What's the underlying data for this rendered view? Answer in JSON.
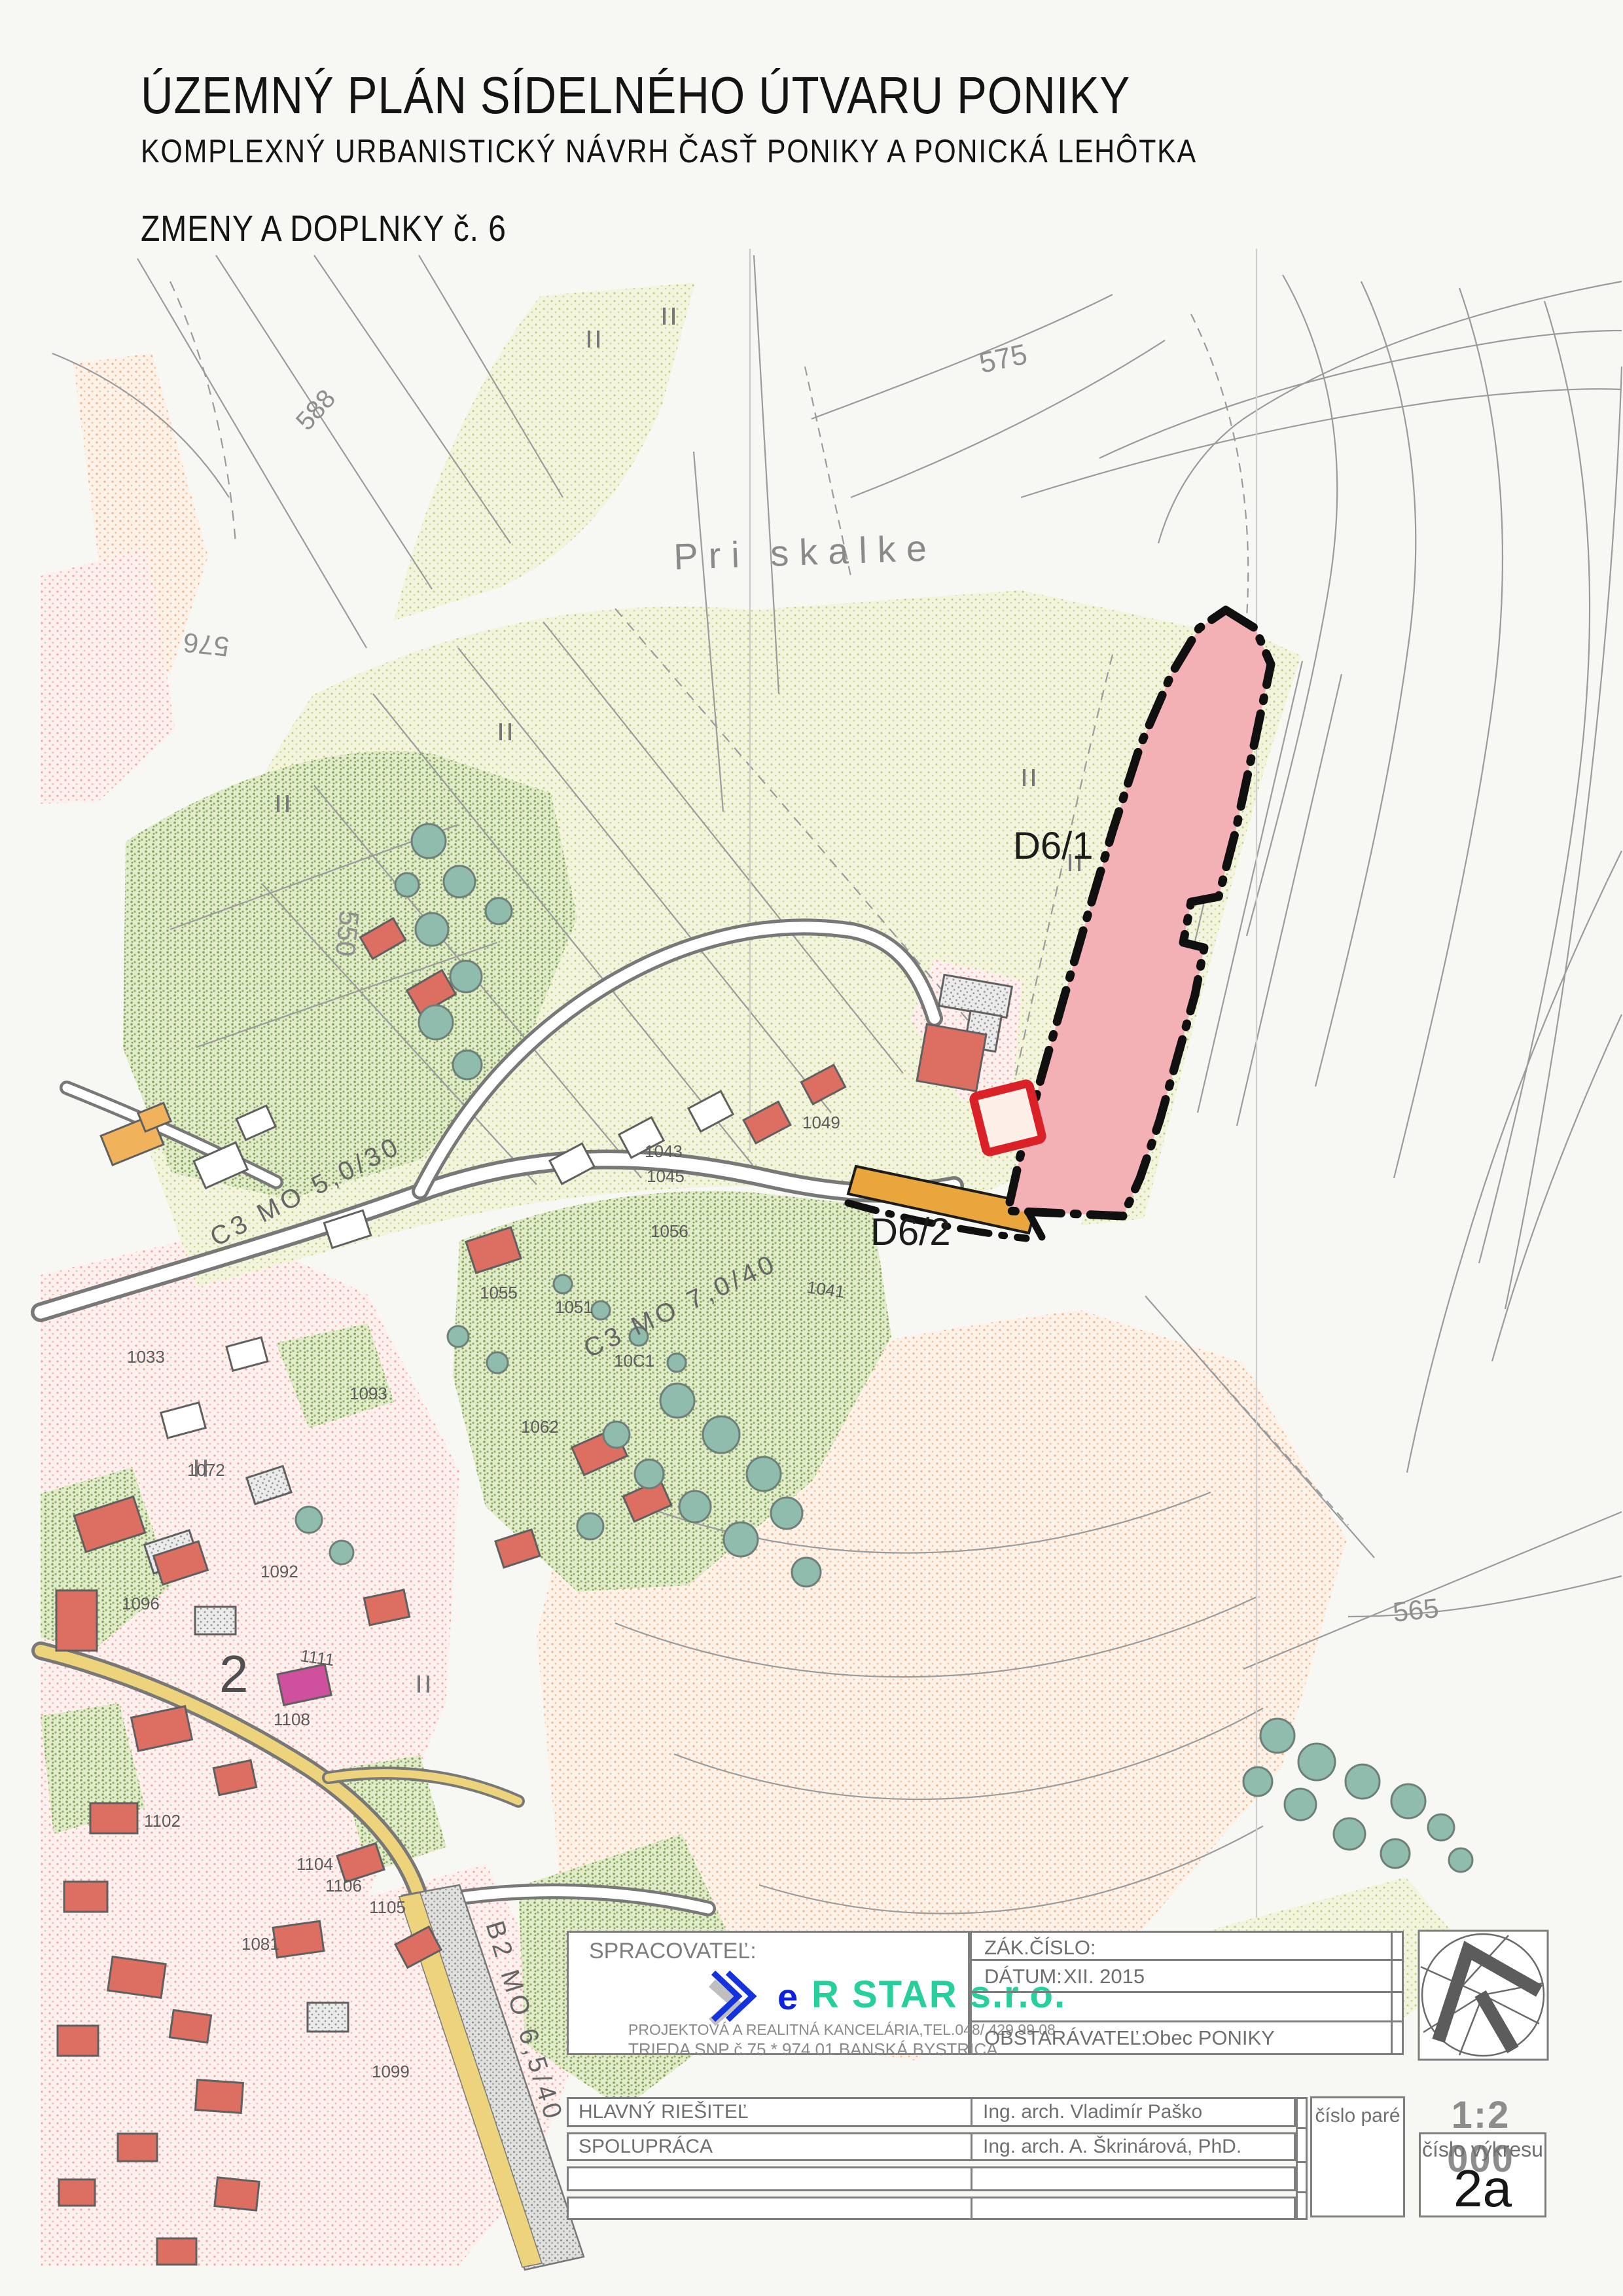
{
  "header": {
    "title": "ÚZEMNÝ PLÁN SÍDELNÉHO ÚTVARU PONIKY",
    "subtitle": "KOMPLEXNÝ URBANISTICKÝ NÁVRH ČASŤ PONIKY A PONICKÁ LEHÔTKA",
    "edition": "ZMENY A DOPLNKY č. 6"
  },
  "map": {
    "place_label": "Pri skalke",
    "change_area_1": "D6/1",
    "change_area_2": "D6/2",
    "district_number": "2",
    "contours": [
      "575",
      "576",
      "588",
      "550",
      "565"
    ],
    "roads": [
      "C3 MO 5,0/30",
      "C3 MO 7,0/40",
      "B2 MO 6,5/40"
    ],
    "parcels": [
      "1041",
      "1043",
      "1045",
      "1049",
      "1051",
      "1055",
      "1056",
      "10C1",
      "1062",
      "1072",
      "1092",
      "1096",
      "1093",
      "1033",
      "1102",
      "1104",
      "1105",
      "1106",
      "1108",
      "1111",
      "1081",
      "1099"
    ]
  },
  "title_block": {
    "spracovatel_label": "SPRACOVATEĽ:",
    "logo": {
      "e": "e",
      "name": "R STAR s.r.o.",
      "line1": "PROJEKTOVÁ A REALITNÁ KANCELÁRIA,TEL.048/ 429 99 08",
      "line2": "TRIEDA SNP  č.75 * 974 01 BANSKÁ BYSTRICA"
    },
    "zak_cislo_label": "ZÁK.ČÍSLO:",
    "datum_label": "DÁTUM:",
    "datum_value": "XII. 2015",
    "obstaravatel_label": "OBSTARÁVATEĽ:",
    "obstaravatel_value": "Obec PONIKY",
    "rows": [
      {
        "label": "HLAVNÝ RIEŠITEĽ",
        "value": "Ing. arch. Vladimír Paško"
      },
      {
        "label": "SPOLUPRÁCA",
        "value": "Ing. arch. A. Škrinárová, PhD."
      },
      {
        "label": "",
        "value": ""
      },
      {
        "label": "",
        "value": ""
      }
    ],
    "cislo_pare_label": "číslo paré",
    "scale": "1:2 000",
    "cislo_vykresu_label": "číslo výkresu",
    "drawing_number": "2a"
  },
  "colors": {
    "change_area_fill": "#f3b1b5",
    "change_boundary": "#101010",
    "d62_road_orange": "#e9a63d",
    "red_building": "#dd6e62",
    "yellow_road": "#ecd37c",
    "logo_blue": "#1433dd",
    "logo_teal": "#27cf9c",
    "red_marker": "#da2128"
  }
}
